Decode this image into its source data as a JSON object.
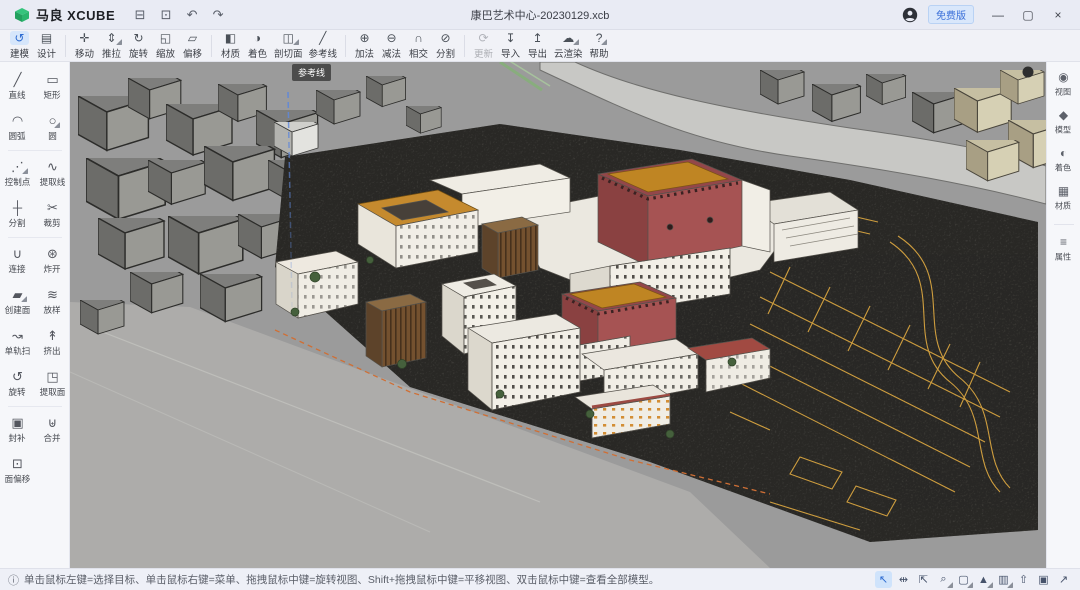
{
  "window": {
    "app_name": "马良 XCUBE",
    "doc_title": "康巴艺术中心-20230129.xcb",
    "version_badge": "免费版",
    "quick_actions": [
      {
        "id": "open-file",
        "glyph": "⊟"
      },
      {
        "id": "save-file",
        "glyph": "⊡"
      },
      {
        "id": "undo",
        "glyph": "↶"
      },
      {
        "id": "redo",
        "glyph": "↷"
      }
    ],
    "controls": [
      {
        "id": "minimize",
        "glyph": "—"
      },
      {
        "id": "maximize",
        "glyph": "▢"
      },
      {
        "id": "close",
        "glyph": "×"
      }
    ]
  },
  "main_toolbar": {
    "groups": [
      [
        {
          "id": "modeling",
          "label": "建模",
          "glyph": "↺",
          "active": true
        },
        {
          "id": "design",
          "label": "设计",
          "glyph": "▤"
        }
      ],
      [
        {
          "id": "move",
          "label": "移动",
          "glyph": "✛"
        },
        {
          "id": "push-pull",
          "label": "推拉",
          "glyph": "⇕",
          "caret": true
        },
        {
          "id": "rotate",
          "label": "旋转",
          "glyph": "↻"
        },
        {
          "id": "scale",
          "label": "缩放",
          "glyph": "◱"
        },
        {
          "id": "offset",
          "label": "偏移",
          "glyph": "▱"
        }
      ],
      [
        {
          "id": "material",
          "label": "材质",
          "glyph": "◧"
        },
        {
          "id": "shading",
          "label": "着色",
          "glyph": "◑"
        },
        {
          "id": "section-plane",
          "label": "剖切面",
          "glyph": "◫",
          "caret": true
        },
        {
          "id": "guide-line",
          "label": "参考线",
          "glyph": "╱"
        }
      ],
      [
        {
          "id": "boolean-add",
          "label": "加法",
          "glyph": "⊕"
        },
        {
          "id": "boolean-subtract",
          "label": "减法",
          "glyph": "⊖"
        },
        {
          "id": "boolean-intersect",
          "label": "相交",
          "glyph": "∩"
        },
        {
          "id": "boolean-split",
          "label": "分割",
          "glyph": "⊘"
        }
      ],
      [
        {
          "id": "update",
          "label": "更新",
          "glyph": "⟳",
          "disabled": true
        },
        {
          "id": "import",
          "label": "导入",
          "glyph": "↧"
        },
        {
          "id": "export",
          "label": "导出",
          "glyph": "↥"
        },
        {
          "id": "cloud-render",
          "label": "云渲染",
          "glyph": "☁",
          "caret": true
        },
        {
          "id": "help",
          "label": "帮助",
          "glyph": "?",
          "caret": true
        }
      ]
    ]
  },
  "left_tools": {
    "rows": [
      [
        {
          "id": "line",
          "label": "直线",
          "glyph": "╱"
        },
        {
          "id": "rectangle",
          "label": "矩形",
          "glyph": "▭"
        }
      ],
      [
        {
          "id": "arc",
          "label": "圆弧",
          "glyph": "◠"
        },
        {
          "id": "circle",
          "label": "圆",
          "glyph": "○",
          "caret": true
        }
      ],
      [
        {
          "id": "control-point",
          "label": "控制点",
          "glyph": "⋰",
          "caret": true
        },
        {
          "id": "extract-line",
          "label": "提取线",
          "glyph": "∿"
        }
      ],
      [
        {
          "id": "split",
          "label": "分割",
          "glyph": "┼"
        },
        {
          "id": "trim",
          "label": "裁剪",
          "glyph": "✂"
        }
      ],
      [
        {
          "id": "connect",
          "label": "连接",
          "glyph": "∪"
        },
        {
          "id": "explode",
          "label": "炸开",
          "glyph": "⊛"
        }
      ],
      [
        {
          "id": "create-face",
          "label": "创建面",
          "glyph": "▰",
          "caret": true
        },
        {
          "id": "loft",
          "label": "放样",
          "glyph": "≋"
        }
      ],
      [
        {
          "id": "sweep-one-rail",
          "label": "单轨扫",
          "glyph": "↝"
        },
        {
          "id": "extrude",
          "label": "挤出",
          "glyph": "↟"
        }
      ],
      [
        {
          "id": "revolve",
          "label": "旋转",
          "glyph": "↺"
        },
        {
          "id": "extract-face",
          "label": "提取面",
          "glyph": "◳"
        }
      ],
      [
        {
          "id": "patch",
          "label": "封补",
          "glyph": "▣"
        },
        {
          "id": "merge",
          "label": "合并",
          "glyph": "⊎"
        }
      ],
      [
        {
          "id": "face-offset",
          "label": "面偏移",
          "glyph": "⊡"
        },
        null
      ]
    ],
    "dividers_after_rows": [
      1,
      3,
      7
    ]
  },
  "right_panel": {
    "items": [
      {
        "id": "view",
        "label": "视图",
        "glyph": "◉"
      },
      {
        "id": "model",
        "label": "模型",
        "glyph": "◆"
      },
      {
        "id": "shading",
        "label": "着色",
        "glyph": "◐"
      },
      {
        "id": "material",
        "label": "材质",
        "glyph": "▦"
      },
      {
        "id": "properties",
        "label": "属性",
        "glyph": "≡",
        "divider_before": true
      }
    ]
  },
  "viewport": {
    "tooltip": "参考线"
  },
  "statusbar": {
    "info_glyph": "ⓘ",
    "hint": "单击鼠标左键=选择目标、单击鼠标右键=菜单、拖拽鼠标中键=旋转视图、Shift+拖拽鼠标中键=平移视图、双击鼠标中键=查看全部模型。",
    "tools": [
      {
        "id": "select-tool",
        "glyph": "↖",
        "active": true
      },
      {
        "id": "pan-tool",
        "glyph": "⇹"
      },
      {
        "id": "orbit-tool",
        "glyph": "⇱"
      },
      {
        "id": "zoom-tool",
        "glyph": "⌕",
        "caret": true
      },
      {
        "id": "display-box",
        "glyph": "▢",
        "caret": true
      },
      {
        "id": "display-shaded",
        "glyph": "▲",
        "caret": true
      },
      {
        "id": "viewport-layout",
        "glyph": "▥",
        "caret": true
      },
      {
        "id": "walk-tool",
        "glyph": "⇧"
      },
      {
        "id": "snapshot-tool",
        "glyph": "▣"
      },
      {
        "id": "fullscreen-tool",
        "glyph": "↗"
      }
    ]
  },
  "colors": {
    "brand_green": "#2fbe76",
    "badge_blue": "#3a6fd8",
    "active_tool_bg": "#d6e6fb",
    "roof_orange": "#bf8523",
    "wall_maroon": "#a65353",
    "site_line_yellow": "#d7a440",
    "guide_blue": "#5f87d9",
    "boundary_orange": "#cf6f35"
  }
}
